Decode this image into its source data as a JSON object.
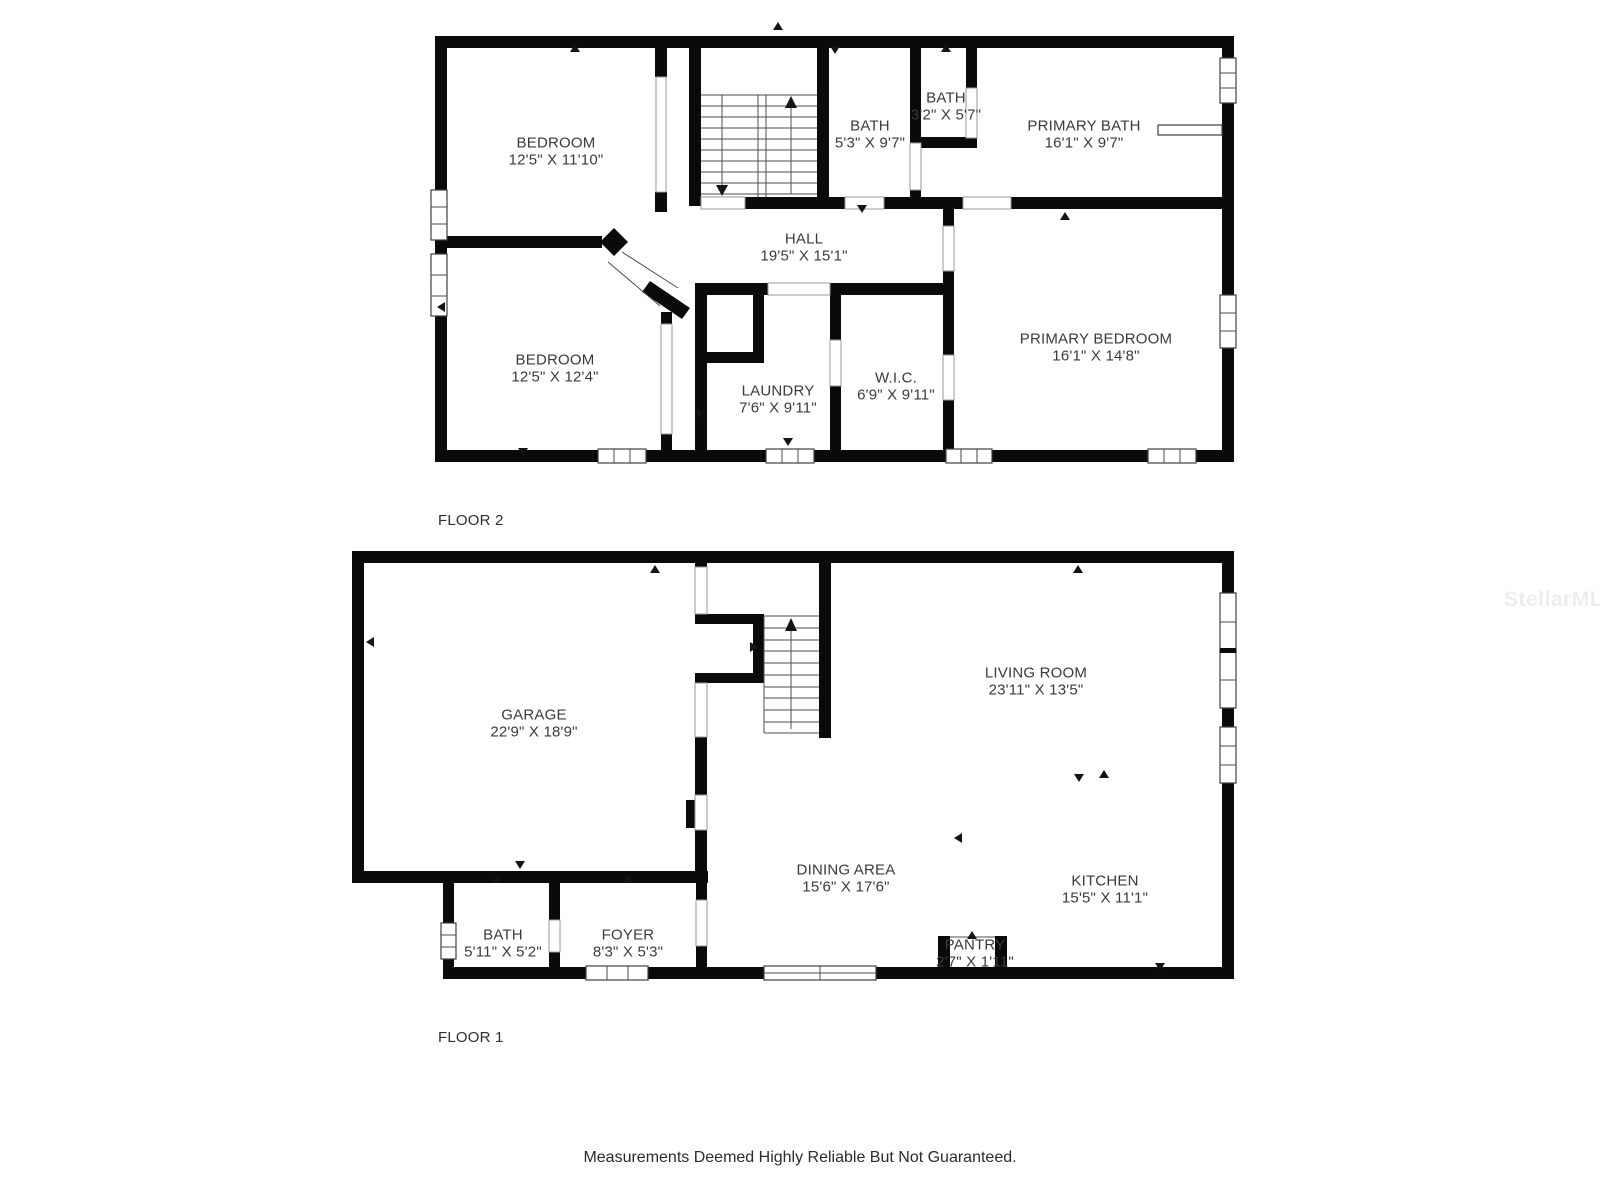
{
  "floor2": {
    "label": "FLOOR 2",
    "rooms": [
      {
        "name": "BEDROOM",
        "dims": "12'5\" X 11'10\""
      },
      {
        "name": "BATH",
        "dims": "5'3\" X 9'7\""
      },
      {
        "name": "BATH",
        "dims": "3'2\" X 5'7\""
      },
      {
        "name": "PRIMARY BATH",
        "dims": "16'1\" X 9'7\""
      },
      {
        "name": "HALL",
        "dims": "19'5\" X 15'1\""
      },
      {
        "name": "BEDROOM",
        "dims": "12'5\" X 12'4\""
      },
      {
        "name": "LAUNDRY",
        "dims": "7'6\" X 9'11\""
      },
      {
        "name": "W.I.C.",
        "dims": "6'9\" X 9'11\""
      },
      {
        "name": "PRIMARY BEDROOM",
        "dims": "16'1\" X 14'8\""
      }
    ]
  },
  "floor1": {
    "label": "FLOOR 1",
    "rooms": [
      {
        "name": "GARAGE",
        "dims": "22'9\" X 18'9\""
      },
      {
        "name": "LIVING ROOM",
        "dims": "23'11\" X 13'5\""
      },
      {
        "name": "DINING AREA",
        "dims": "15'6\" X 17'6\""
      },
      {
        "name": "KITCHEN",
        "dims": "15'5\" X 11'1\""
      },
      {
        "name": "BATH",
        "dims": "5'11\" X 5'2\""
      },
      {
        "name": "FOYER",
        "dims": "8'3\" X 5'3\""
      },
      {
        "name": "PANTRY",
        "dims": "2'7\" X 1'11\""
      }
    ]
  },
  "watermark": "StellarMLS",
  "disclaimer": "Measurements Deemed Highly Reliable But Not Guaranteed.",
  "colors": {
    "wall": "#0a0a0a",
    "label_text": "#3a3a3a",
    "watermark": "#ededed"
  }
}
